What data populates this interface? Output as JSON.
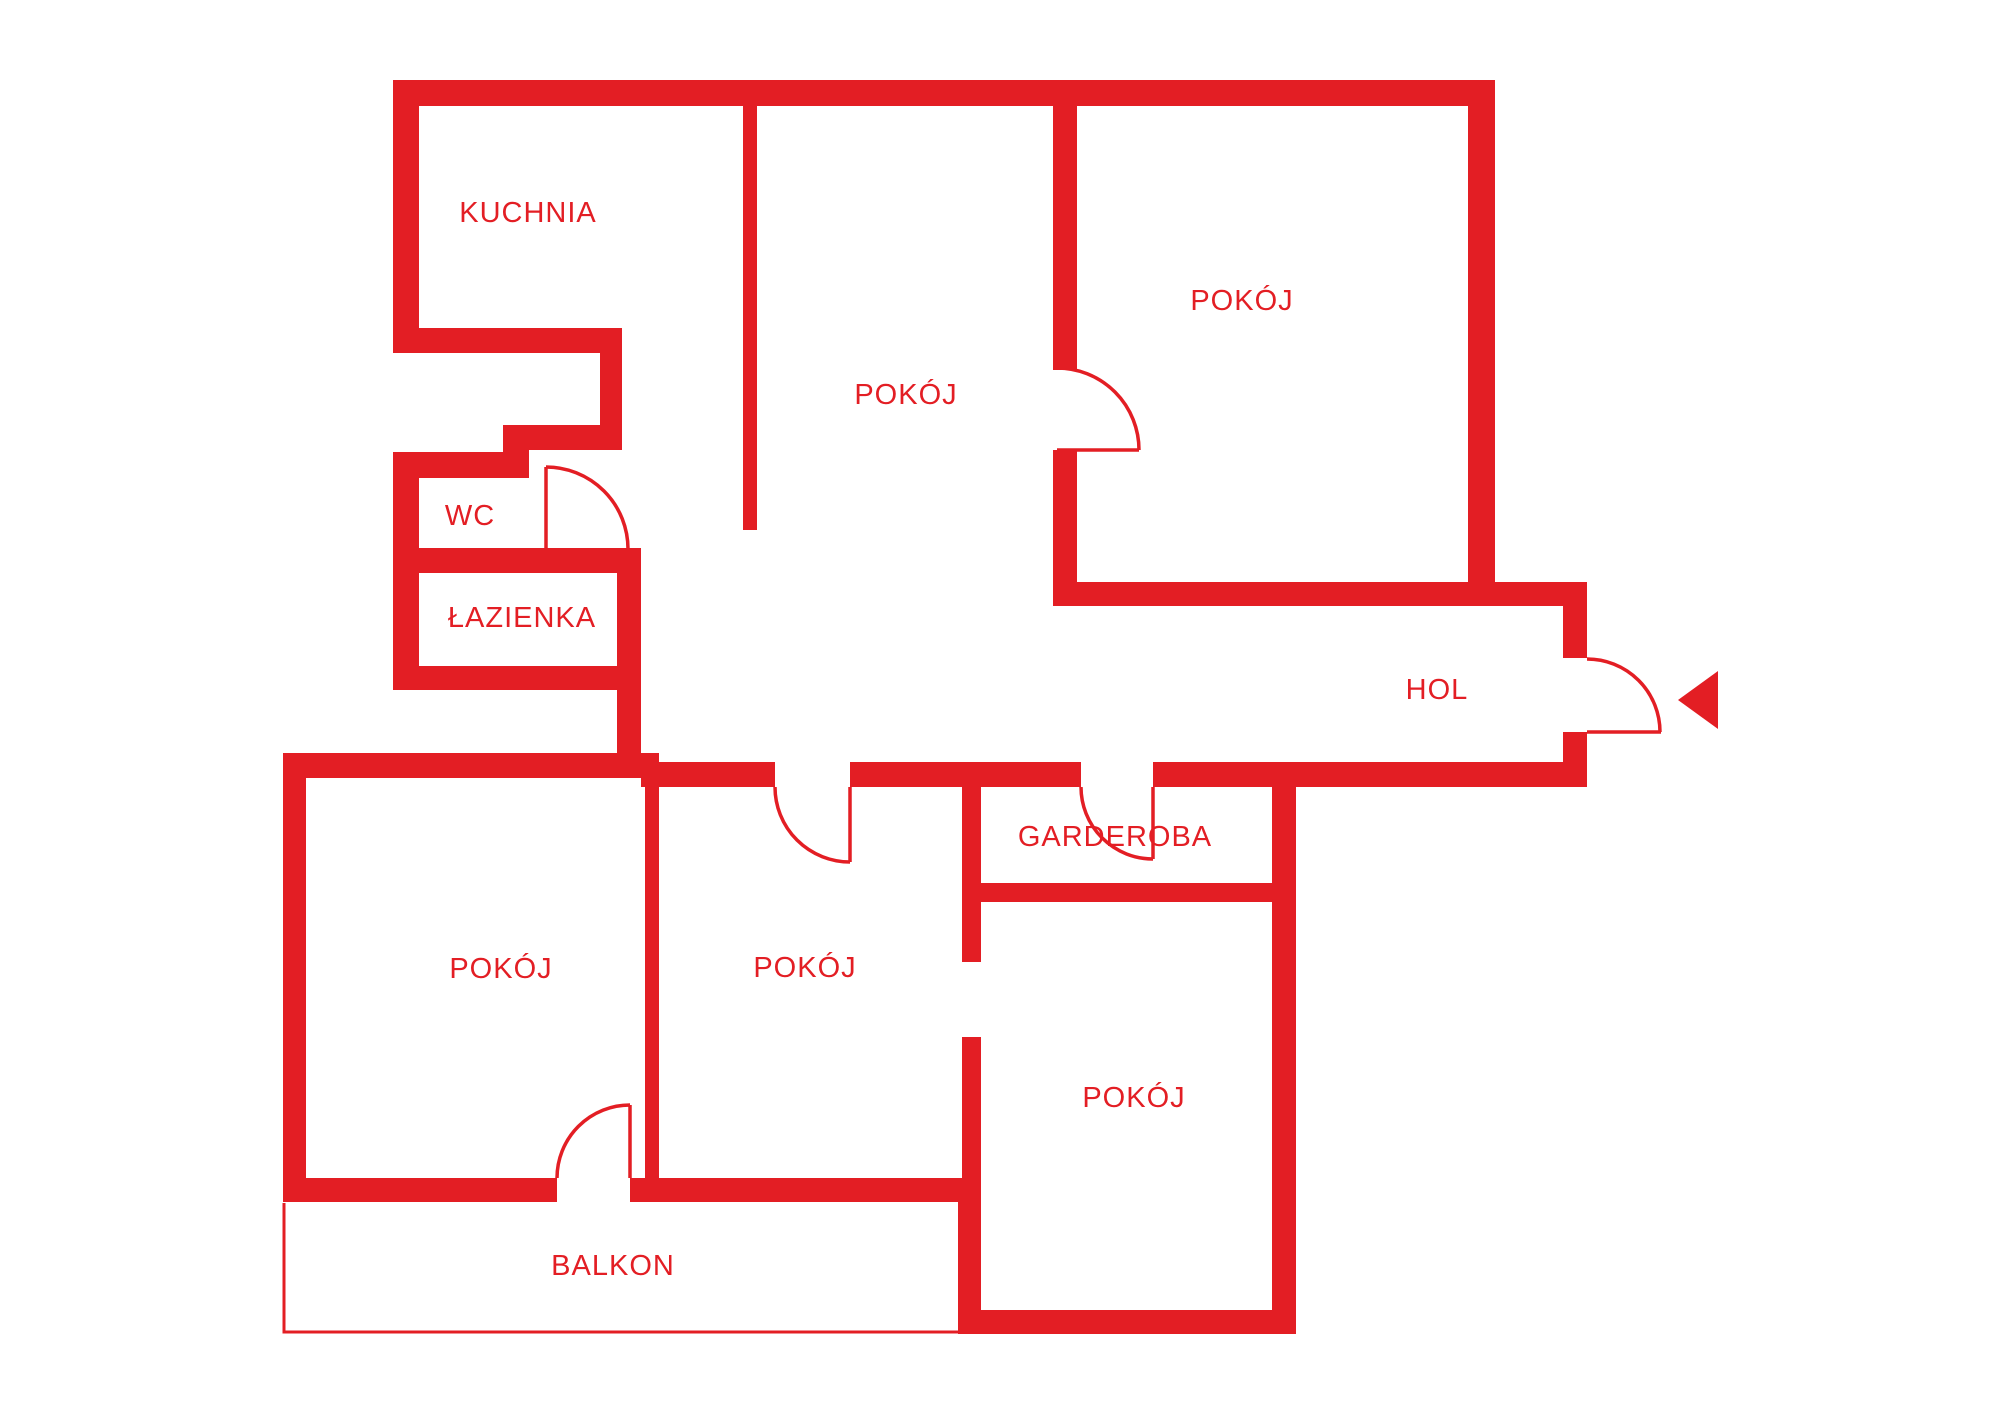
{
  "plan": {
    "type": "apartment-floor-plan",
    "background_color": "#ffffff",
    "wall_color": "#e31e24",
    "label_color": "#e31e24",
    "rooms": [
      {
        "name": "kitchen",
        "label": "KUCHNIA"
      },
      {
        "name": "room-top-middle",
        "label": "POKÓJ"
      },
      {
        "name": "room-top-right",
        "label": "POKÓJ"
      },
      {
        "name": "wc",
        "label": "WC"
      },
      {
        "name": "bathroom",
        "label": "ŁAZIENKA"
      },
      {
        "name": "hall",
        "label": "HOL"
      },
      {
        "name": "wardrobe",
        "label": "GARDEROBA"
      },
      {
        "name": "room-bottom-left",
        "label": "POKÓJ"
      },
      {
        "name": "room-bottom-middle",
        "label": "POKÓJ"
      },
      {
        "name": "room-bottom-right",
        "label": "POKÓJ"
      },
      {
        "name": "balcony",
        "label": "BALKON"
      }
    ],
    "entrance": {
      "marker": "arrow-pointing-left-at-main-door"
    }
  }
}
